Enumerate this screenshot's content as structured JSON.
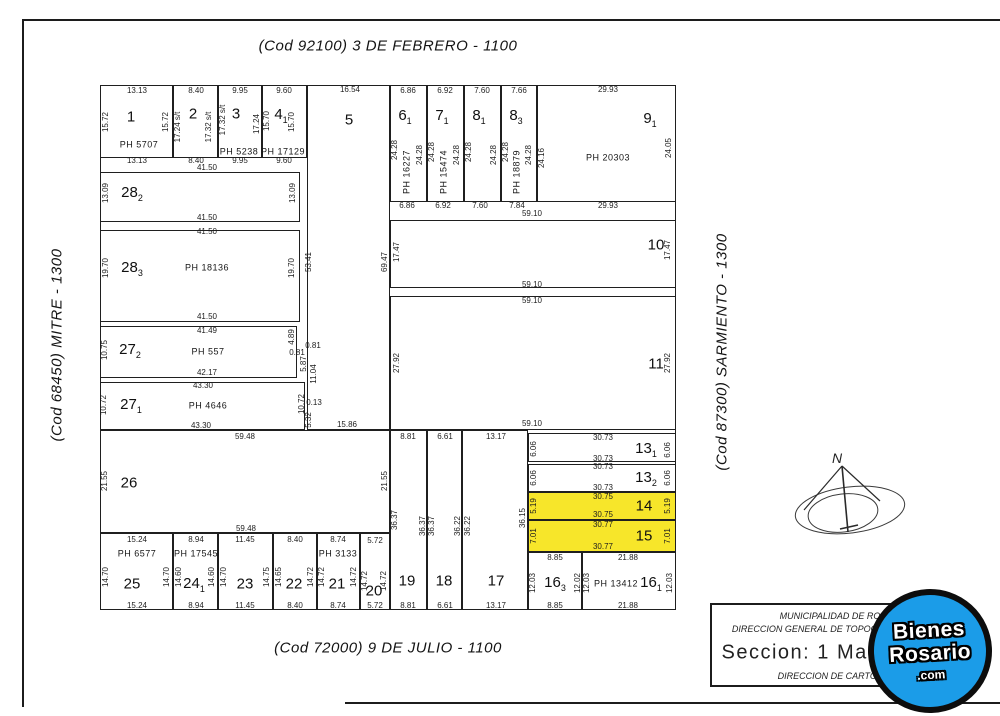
{
  "colors": {
    "highlight_yellow": "#f7e62a",
    "logo_blue": "#1b9ce8",
    "line_black": "#1c1c1c"
  },
  "streets": {
    "top": "(Cod  92100)   3 DE FEBRERO - 1100",
    "bottom": "(Cod  72000)   9 DE JULIO - 1100",
    "left": "(Cod  68450)   MITRE - 1300",
    "right": "(Cod  87300)   SARMIENTO - 1300"
  },
  "parcels": {
    "p1": {
      "num": "1",
      "ph": "PH 5707",
      "top": "13.13",
      "bottom": "13.13",
      "left": "15.72",
      "right": "15.72"
    },
    "p2": {
      "num": "2",
      "top": "8.40",
      "bottom": "8.40",
      "left": "17.24 s/t",
      "right": "17.32 s/t"
    },
    "p3": {
      "num": "3",
      "ph": "PH 5238",
      "top": "9.95",
      "bottom": "9.95",
      "left": "17.32 s/t",
      "right": "17.24"
    },
    "p4": {
      "num": "4",
      "sub": "1",
      "ph": "PH 17129",
      "top": "9.60",
      "bottom": "9.60",
      "left": "15.70",
      "right": "15.70"
    },
    "p5": {
      "num": "5",
      "top": "16.54"
    },
    "p6": {
      "num": "6",
      "sub": "1",
      "ph": "PH 16227",
      "top": "6.86",
      "bottom": "6.86",
      "left": "24.28",
      "right": "24.28"
    },
    "p7": {
      "num": "7",
      "sub": "1",
      "ph": "PH 15474",
      "top": "6.92",
      "bottom": "6.92",
      "left": "24.28",
      "right": "24.28"
    },
    "p8a": {
      "num": "8",
      "sub": "1",
      "top": "7.60",
      "bottom": "7.60",
      "left": "24.28",
      "right": "24.28"
    },
    "p8b": {
      "num": "8",
      "sub": "3",
      "ph": "PH 18879",
      "top": "7.66",
      "bottom": "7.84",
      "left": "24.28",
      "right": "24.28"
    },
    "p9": {
      "num": "9",
      "sub": "1",
      "ph": "PH 20303",
      "top": "29.93",
      "bottom": "29.93",
      "right": "24.05"
    },
    "p10": {
      "num": "10",
      "top": "59.10",
      "bottom": "59.10",
      "left": "17.47",
      "right": "17.47"
    },
    "p11": {
      "num": "11",
      "top": "59.10",
      "bottom": "59.10",
      "left": "27.92",
      "right": "27.92"
    },
    "p13a": {
      "num": "13",
      "sub": "1",
      "top": "30.73",
      "bottom": "30.73",
      "left": "6.06",
      "right": "6.06"
    },
    "p13b": {
      "num": "13",
      "sub": "2",
      "top": "30.73",
      "bottom": "30.73",
      "left": "6.06",
      "right": "6.06"
    },
    "p14": {
      "num": "14",
      "top": "30.75",
      "bottom": "30.75",
      "left": "5.19",
      "right": "5.19"
    },
    "p15": {
      "num": "15",
      "top": "30.77",
      "bottom": "30.77",
      "left": "7.01",
      "right": "7.01"
    },
    "p16a": {
      "num": "16",
      "sub": "3",
      "top": "8.85",
      "bottom": "8.85",
      "left": "12.03",
      "right": "12.02"
    },
    "p16b": {
      "num": "16",
      "sub": "1",
      "ph": "PH 13412",
      "top": "21.88",
      "bottom": "21.88",
      "left": "12.03",
      "right": "12.03"
    },
    "p17": {
      "num": "17",
      "top": "13.17",
      "bottom": "13.17",
      "left": "36.22",
      "right": "36.15"
    },
    "p18": {
      "num": "18",
      "top": "6.61",
      "bottom": "6.61",
      "left": "36.37",
      "right": "36.22"
    },
    "p19": {
      "num": "19",
      "top": "8.81",
      "bottom": "8.81",
      "left": "36.37",
      "right": "36.37"
    },
    "p20": {
      "num": "20",
      "top": "5.72",
      "bottom": "5.72",
      "left": "14.72",
      "right": "14.72"
    },
    "p21": {
      "num": "21",
      "ph": "PH 3133",
      "top": "8.74",
      "bottom": "8.74",
      "left": "14.72",
      "right": "14.72"
    },
    "p22": {
      "num": "22",
      "top": "8.40",
      "bottom": "8.40",
      "left": "14.65",
      "right": "14.72"
    },
    "p23": {
      "num": "23",
      "top": "11.45",
      "bottom": "11.45",
      "left": "14.70",
      "right": "14.75"
    },
    "p24": {
      "num": "24",
      "sub": "1",
      "ph": "PH 17545",
      "top": "8.94",
      "bottom": "8.94",
      "left": "14.60",
      "right": "14.60"
    },
    "p25": {
      "num": "25",
      "ph": "PH 6577",
      "top": "15.24",
      "bottom": "15.24",
      "left": "14.70",
      "right": "14.70"
    },
    "p26": {
      "num": "26",
      "top": "59.48",
      "bottom": "59.48",
      "left": "21.55",
      "right": "21.55"
    },
    "p27a": {
      "num": "27",
      "sub": "1",
      "ph": "PH 4646",
      "top": "43.30",
      "bottom": "43.30",
      "left": "10.72"
    },
    "p27b": {
      "num": "27",
      "sub": "2",
      "ph": "PH 557",
      "top": "41.49",
      "bottom": "42.17",
      "left": "10.75"
    },
    "p28a": {
      "num": "28",
      "sub": "2",
      "bottom": "41.50",
      "left": "13.09",
      "right": "13.09"
    },
    "p28b": {
      "num": "28",
      "sub": "3",
      "ph": "PH 18136",
      "top": "41.50",
      "bottom": "41.50",
      "left": "19.70",
      "right": "19.70"
    }
  },
  "extra_dims": {
    "row1_bottom_total": "41.50",
    "block5_left_lower": "53.41",
    "block5_right": "69.47",
    "block5_bottom": "15.86",
    "d9_left": "24.16",
    "notch_489": "4.89",
    "notch_081a": "0.81",
    "notch_081b": "0.81",
    "notch_587": "5.87",
    "notch_1104": "11.04",
    "notch_1072": "10.72",
    "notch_013": "0.13",
    "notch_532": "5.32"
  },
  "title_block": {
    "line1": "MUNICIPALIDAD DE RO",
    "line2": "DIRECCION GENERAL DE TOPOGR",
    "line3": "Seccion: 1  Manzo",
    "line4": "DIRECCION DE CARTOGR"
  },
  "logo": {
    "word1": "Bienes",
    "word2": "Rosario",
    "word3": ".com"
  },
  "compass": {
    "north": "N"
  }
}
